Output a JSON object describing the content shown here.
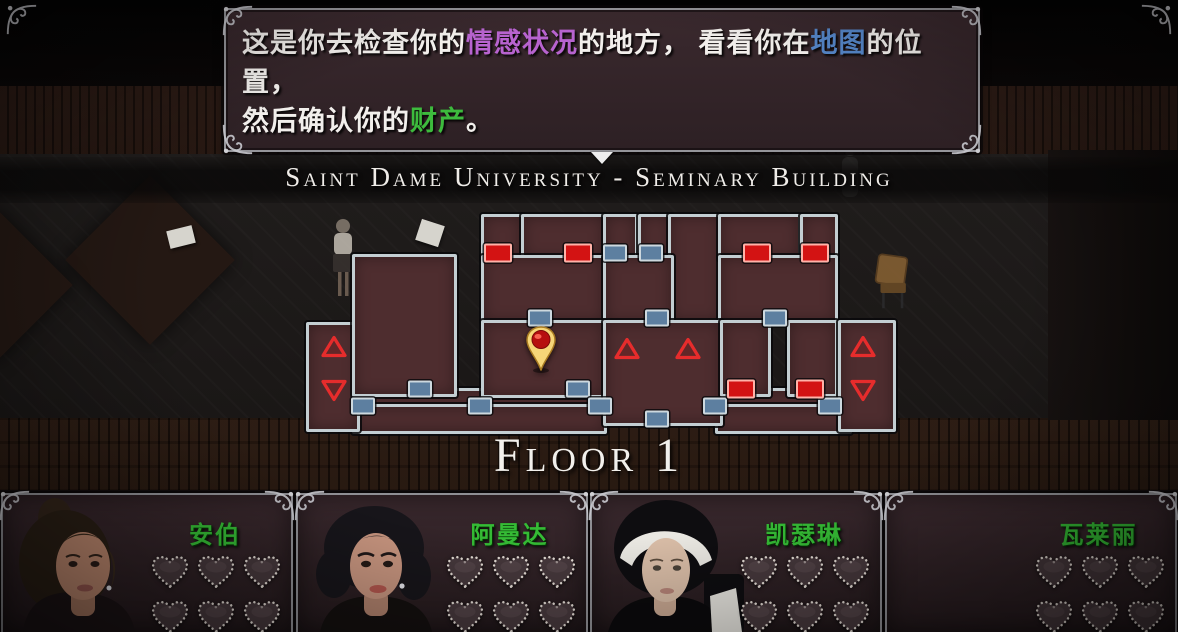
{
  "dialogue": {
    "lines": [
      [
        {
          "text": "这是你去检查你的",
          "color": "#f2efec"
        },
        {
          "text": "情感状况",
          "color": "#b763cf"
        },
        {
          "text": "的地方， 看看你在",
          "color": "#f2efec"
        },
        {
          "text": "地图",
          "color": "#5586c8"
        },
        {
          "text": "的位置，",
          "color": "#f2efec"
        }
      ],
      [
        {
          "text": "然后确认你的",
          "color": "#f2efec"
        },
        {
          "text": "财产",
          "color": "#3dbb3d"
        },
        {
          "text": "。",
          "color": "#f2efec"
        }
      ]
    ]
  },
  "map": {
    "title": "Saint Dame University - Seminary Building",
    "floor_label": "Floor 1",
    "pin": {
      "x": 241,
      "y": 149
    },
    "rooms": [
      {
        "x": 52,
        "y": 185,
        "w": 492,
        "h": 20
      },
      {
        "x": 52,
        "y": 201,
        "w": 249,
        "h": 24
      },
      {
        "x": 415,
        "y": 201,
        "w": 131,
        "h": 24
      },
      {
        "x": 6,
        "y": 119,
        "w": 48,
        "h": 104
      },
      {
        "x": 52,
        "y": 51,
        "w": 99,
        "h": 137
      },
      {
        "x": 181,
        "y": 11,
        "w": 37,
        "h": 41
      },
      {
        "x": 221,
        "y": 11,
        "w": 79,
        "h": 41
      },
      {
        "x": 303,
        "y": 11,
        "w": 29,
        "h": 41
      },
      {
        "x": 338,
        "y": 11,
        "w": 29,
        "h": 41
      },
      {
        "x": 368,
        "y": 11,
        "w": 49,
        "h": 103
      },
      {
        "x": 418,
        "y": 11,
        "w": 77,
        "h": 41
      },
      {
        "x": 500,
        "y": 11,
        "w": 32,
        "h": 41
      },
      {
        "x": 181,
        "y": 52,
        "w": 119,
        "h": 63
      },
      {
        "x": 303,
        "y": 52,
        "w": 65,
        "h": 63
      },
      {
        "x": 418,
        "y": 52,
        "w": 114,
        "h": 63
      },
      {
        "x": 181,
        "y": 117,
        "w": 119,
        "h": 72
      },
      {
        "x": 303,
        "y": 117,
        "w": 114,
        "h": 100
      },
      {
        "x": 420,
        "y": 117,
        "w": 45,
        "h": 71
      },
      {
        "x": 487,
        "y": 117,
        "w": 45,
        "h": 71
      },
      {
        "x": 538,
        "y": 117,
        "w": 52,
        "h": 106
      }
    ],
    "doors": [
      {
        "x": 120,
        "y": 186,
        "type": "blue"
      },
      {
        "x": 278,
        "y": 186,
        "type": "blue"
      },
      {
        "x": 63,
        "y": 203,
        "type": "blue"
      },
      {
        "x": 180,
        "y": 203,
        "type": "blue"
      },
      {
        "x": 300,
        "y": 203,
        "type": "blue"
      },
      {
        "x": 415,
        "y": 203,
        "type": "blue"
      },
      {
        "x": 530,
        "y": 203,
        "type": "blue"
      },
      {
        "x": 357,
        "y": 216,
        "type": "blue"
      },
      {
        "x": 240,
        "y": 115,
        "type": "blue"
      },
      {
        "x": 357,
        "y": 115,
        "type": "blue"
      },
      {
        "x": 475,
        "y": 115,
        "type": "blue"
      },
      {
        "x": 315,
        "y": 50,
        "type": "blue"
      },
      {
        "x": 351,
        "y": 50,
        "type": "blue"
      },
      {
        "x": 198,
        "y": 50,
        "type": "red"
      },
      {
        "x": 278,
        "y": 50,
        "type": "red"
      },
      {
        "x": 457,
        "y": 50,
        "type": "red"
      },
      {
        "x": 515,
        "y": 50,
        "type": "red"
      },
      {
        "x": 441,
        "y": 186,
        "type": "red"
      },
      {
        "x": 510,
        "y": 186,
        "type": "red"
      }
    ],
    "stairs": [
      {
        "x": 34,
        "y": 146,
        "dir": "up"
      },
      {
        "x": 34,
        "y": 190,
        "dir": "down"
      },
      {
        "x": 327,
        "y": 148,
        "dir": "up"
      },
      {
        "x": 388,
        "y": 148,
        "dir": "up"
      },
      {
        "x": 563,
        "y": 146,
        "dir": "up"
      },
      {
        "x": 563,
        "y": 190,
        "dir": "down"
      }
    ]
  },
  "characters": [
    {
      "name": "安伯",
      "portrait": "amber",
      "hearts_rows": 2,
      "hearts_cols": 3,
      "hearts_filled": 0
    },
    {
      "name": "阿曼达",
      "portrait": "amanda",
      "hearts_rows": 2,
      "hearts_cols": 3,
      "hearts_filled": 0
    },
    {
      "name": "凯瑟琳",
      "portrait": "katherine",
      "hearts_rows": 2,
      "hearts_cols": 3,
      "hearts_filled": 0
    },
    {
      "name": "瓦莱丽",
      "portrait": "none",
      "hearts_rows": 2,
      "hearts_cols": 3,
      "hearts_filled": 0
    }
  ],
  "colors": {
    "name_green": "#35bb35",
    "door_blue": "#5d7fa0",
    "door_red": "#d31313",
    "arrow_red": "#e62c2c",
    "pin_gold": "#f6d678",
    "wall": "#c3ced2",
    "room_fill": "#4e2d2f"
  }
}
